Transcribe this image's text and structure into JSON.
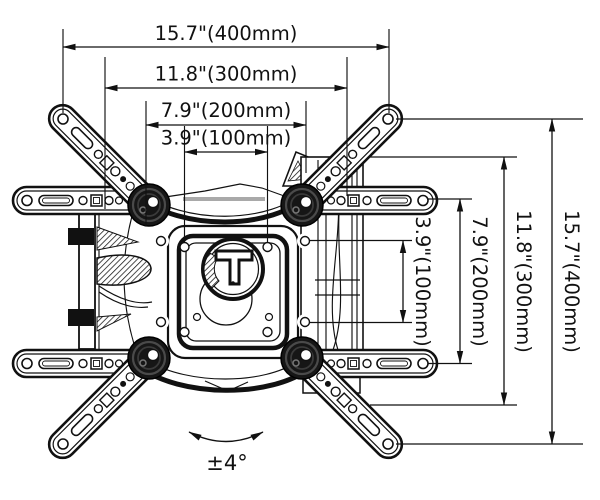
{
  "page": {
    "background": "#ffffff",
    "ink": "#111111"
  },
  "diagram": {
    "dimensions": {
      "horizontal": [
        {
          "label": "15.7\"(400mm)",
          "inches": 15.7,
          "mm": 400
        },
        {
          "label": "11.8\"(300mm)",
          "inches": 11.8,
          "mm": 300
        },
        {
          "label": "7.9\"(200mm)",
          "inches": 7.9,
          "mm": 200
        },
        {
          "label": "3.9\"(100mm)",
          "inches": 3.9,
          "mm": 100
        }
      ],
      "vertical": [
        {
          "label": "15.7\"(400mm)",
          "inches": 15.7,
          "mm": 400
        },
        {
          "label": "11.8\"(300mm)",
          "inches": 11.8,
          "mm": 300
        },
        {
          "label": "7.9\"(200mm)",
          "inches": 7.9,
          "mm": 200
        },
        {
          "label": "3.9\"(100mm)",
          "inches": 3.9,
          "mm": 100
        }
      ],
      "tilt": {
        "label": "±4°",
        "degrees": 4
      }
    }
  }
}
